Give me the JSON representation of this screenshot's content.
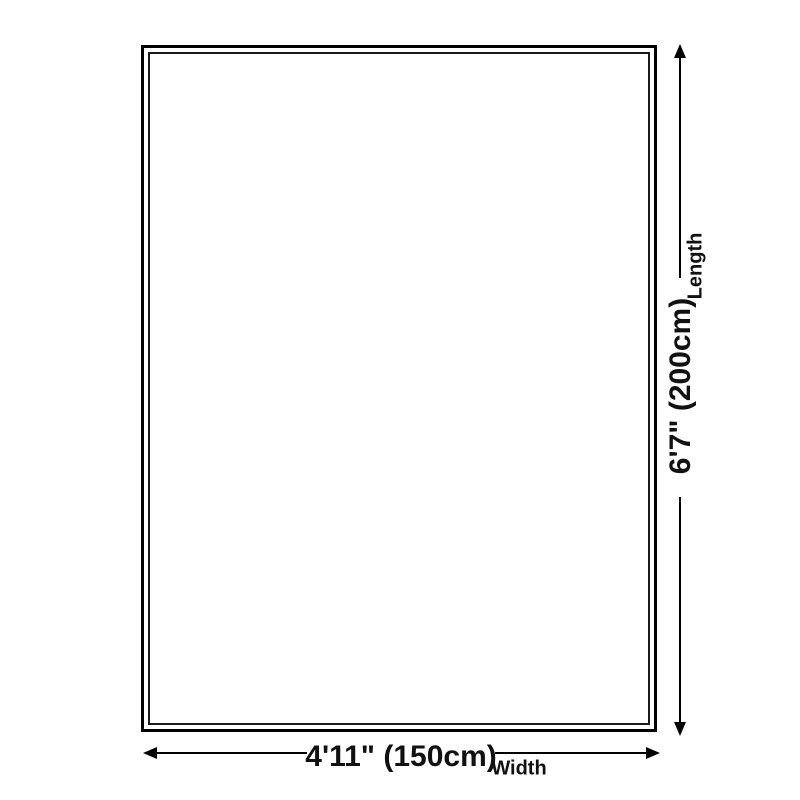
{
  "colors": {
    "background": "#ffffff",
    "line": "#000000",
    "text": "#111111"
  },
  "product": {
    "shape": "rectangle-outline"
  },
  "dimensions": {
    "length": {
      "value": "6'7\" (200cm)",
      "label": "Length"
    },
    "width": {
      "value": "4'11\" (150cm)",
      "label": "Width"
    }
  }
}
